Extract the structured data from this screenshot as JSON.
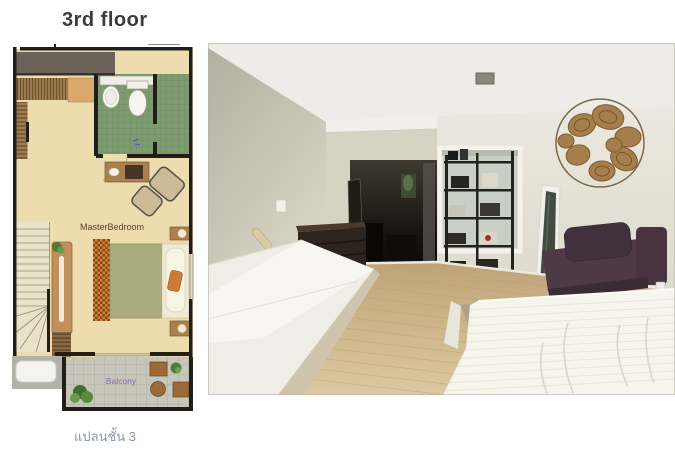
{
  "listing": {
    "type": "real-estate floor plan with room photo"
  },
  "floorplan": {
    "title": "3rd floor",
    "caption": "แปลนชั้น 3",
    "rooms": {
      "master_bedroom": "MasterBedroom",
      "balcony": "Balcony"
    },
    "colors": {
      "bedroom_floor": "#ecdcae",
      "bathroom_tile": "#7e9b70",
      "wall": "#211d18",
      "wardrobe_wood": "#9b7b4e",
      "closet_bar": "#6d6259",
      "bed_blanket": "#a9ad7e",
      "rug_checker": "#8a4516",
      "balcony_tile": "#c6c6bb",
      "balcony_label": "#8a68a8",
      "bedroom_label": "#5a3f28",
      "title_text": "#3c3c3c",
      "caption_text": "#8b96a2"
    }
  },
  "photo": {
    "scene": "empty bedroom with white mattress, purple daybed, black bookshelf, leaning mirror, rattan wall art, dark corridor and wood floor",
    "colors": {
      "ceiling": "#edece6",
      "left_wall": "#c4bfae",
      "right_wall": "#e7e4da",
      "corridor_dark": "#1d1914",
      "wood_floor": "#cdb68c",
      "mattress": "#f5f4ed",
      "sofa_purple": "#4e3947",
      "shelf_black": "#23221c",
      "wall_art_rattan": "#a57e4b"
    }
  }
}
